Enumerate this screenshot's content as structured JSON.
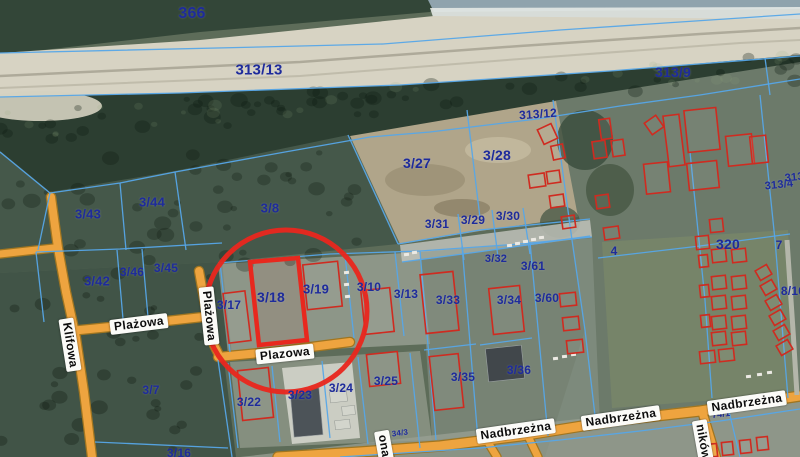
{
  "map": {
    "size": {
      "w": 800,
      "h": 457
    },
    "palette": {
      "base": "#5d6c59",
      "line": "#56a7e8",
      "building_outline": "#cf2b20",
      "highlight": "#e8281e",
      "road_fill": "#eea43f",
      "road_edge": "#a07520",
      "parcel_label": "#1e2b9b",
      "street_label_bg": "#fbfbf8",
      "street_label_text": "#0c0c0c"
    },
    "terrain": [
      {
        "p": "0,0 440,0 430,12 200,32 0,55",
        "f": "#334638"
      },
      {
        "p": "428,0 800,0 800,9 434,12",
        "f": "#8fa3ad"
      },
      {
        "p": "430,8 800,7 800,20 434,20",
        "f": "#e4e9e6",
        "o": 0.9
      },
      {
        "p": "0,53 200,40 434,16 800,19 800,58 610,72 400,86 180,94 0,98",
        "f": "#d7d3c3"
      },
      {
        "p": "0,97 180,93 400,85 610,71 800,55 800,80 700,94 620,105 537,118 430,131 370,136 285,151 175,171 120,182 50,192 0,151",
        "f": "#2c3e31"
      },
      {
        "e": [
          40,
          106,
          62,
          15
        ],
        "f": "#d5d1c1",
        "o": 0.9
      },
      {
        "p": "0,151 50,192 175,171 348,135 398,244 222,262 0,273",
        "f": "#45584a"
      },
      {
        "p": "0,273 222,262 232,355 224,360 236,457 0,457",
        "f": "#415447"
      },
      {
        "p": "553,101 800,62 800,457 545,457 585,330 572,240",
        "f": "#6c7a6a"
      },
      {
        "p": "350,136 556,101 578,217 480,231 400,244",
        "f": "#b0a58a"
      },
      {
        "e": [
          425,
          180,
          40,
          16
        ],
        "f": "#9b9074",
        "o": 0.8
      },
      {
        "e": [
          498,
          150,
          33,
          13
        ],
        "f": "#c3b99d",
        "o": 0.9
      },
      {
        "e": [
          462,
          208,
          28,
          9
        ],
        "f": "#8c8166",
        "o": 0.8
      },
      {
        "e": [
          585,
          140,
          28,
          30
        ],
        "f": "#3a4c3c",
        "o": 0.8
      },
      {
        "e": [
          610,
          190,
          24,
          26
        ],
        "f": "#41523f",
        "o": 0.7
      },
      {
        "e": [
          560,
          222,
          20,
          16
        ],
        "f": "#3f5140",
        "o": 0.7
      },
      {
        "p": "602,242 788,230 795,394 612,408",
        "f": "#778569",
        "o": 0.95
      },
      {
        "p": "218,264 420,252 430,344 228,354",
        "f": "#b5b9af",
        "o": 0.55
      },
      {
        "p": "230,362 420,351 432,440 240,448",
        "f": "#adb1a5",
        "o": 0.5
      },
      {
        "p": "282,368 352,362 360,438 292,444",
        "f": "#d7d8cf",
        "o": 0.85
      },
      {
        "p": "400,245 590,220 592,237 402,262",
        "f": "#c5c7bf",
        "o": 0.8
      },
      {
        "p": "420,252 592,238 600,424 432,440",
        "f": "#8d978a",
        "o": 0.55
      },
      {
        "p": "240,457 800,394 800,457",
        "f": "#99a094",
        "o": 0.75
      }
    ],
    "sand_streaks": [
      {
        "p": "0,76 300,62 520,46 700,34 800,28",
        "c": "rgba(80,75,60,0.30)",
        "w": 2.5
      },
      {
        "p": "0,88 300,76 520,59 740,43 800,40",
        "c": "rgba(125,120,100,0.25)",
        "w": 2
      }
    ],
    "roads": [
      {
        "name": "Klifowa",
        "p": "51,197 58,248 66,292 76,338 84,392 92,457",
        "w": 8
      },
      {
        "name": "west-stub",
        "p": "0,254 54,248",
        "w": 7
      },
      {
        "name": "Plazowa-west",
        "p": "70,331 130,325 203,317",
        "w": 8
      },
      {
        "name": "Plazowa-vertical",
        "p": "199,271 206,310 214,345 220,357",
        "w": 8
      },
      {
        "name": "Plazowa-east",
        "p": "218,357 280,351 350,342",
        "w": 8
      },
      {
        "name": "Nadbrzezna",
        "p": "278,457 360,452 440,446 520,436 620,420 700,411 800,396",
        "w": 9
      },
      {
        "name": "branch-ona",
        "p": "382,444 390,457",
        "w": 7
      },
      {
        "name": "branch-1",
        "p": "486,439 497,457",
        "w": 7
      },
      {
        "name": "branch-2",
        "p": "527,434 538,457",
        "w": 7
      },
      {
        "name": "branch-nikow",
        "p": "702,411 716,457",
        "w": 8
      }
    ],
    "paths": [
      {
        "p": "787,240 793,330 797,395",
        "w": 5,
        "c": "#b4b6aa"
      }
    ],
    "boundaries": [
      "0,53 260,47 383,44 560,30 800,14",
      "0,97 180,93 400,85 610,71 800,56",
      "0,152 50,193",
      "50,193 120,183 175,172 285,152 370,137 430,132 537,119 620,106 700,95 800,79",
      "50,193 38,250",
      "120,183 126,250",
      "175,172 186,250",
      "36,252 120,249 222,243",
      "117,250 123,319",
      "142,249 148,317",
      "36,252 44,322",
      "348,135 398,244",
      "467,110 480,218",
      "553,100 572,240 585,330 596,424",
      "398,244 480,230 590,219",
      "458,214 464,260",
      "492,210 498,257",
      "523,208 530,254",
      "402,262 478,252 590,236",
      "218,263 330,254 420,251 520,244 592,237",
      "220,263 230,352",
      "250,262 259,344",
      "298,257 307,340",
      "345,255 354,338",
      "395,252 404,336",
      "420,251 436,440",
      "462,246 478,440",
      "424,350 476,344",
      "530,242 548,436",
      "480,345 532,338",
      "228,363 238,448",
      "272,366 280,442",
      "322,361 330,438",
      "358,357 368,444",
      "410,353 420,448",
      "95,442 228,448",
      "218,360 232,457",
      "598,258 700,246 790,234",
      "690,152 705,300 712,398",
      "760,95 775,240 788,398",
      "765,58 770,95",
      "728,407 740,457",
      "340,457 480,448 560,440 640,431 720,421 800,409"
    ],
    "buildings": [
      [
        226,
        292,
        22,
        50,
        -7
      ],
      [
        305,
        263,
        35,
        45,
        -6
      ],
      [
        363,
        289,
        29,
        44,
        -6
      ],
      [
        423,
        273,
        33,
        59,
        -6
      ],
      [
        491,
        287,
        31,
        46,
        -6
      ],
      [
        240,
        369,
        31,
        50,
        -6
      ],
      [
        368,
        353,
        31,
        32,
        -6
      ],
      [
        432,
        355,
        29,
        54,
        -6
      ],
      [
        560,
        293,
        16,
        13,
        -6
      ],
      [
        563,
        317,
        16,
        13,
        -6
      ],
      [
        567,
        340,
        16,
        13,
        -6
      ],
      [
        540,
        126,
        15,
        16,
        -25
      ],
      [
        552,
        145,
        12,
        14,
        -12
      ],
      [
        529,
        174,
        16,
        13,
        -8
      ],
      [
        547,
        171,
        13,
        12,
        -8
      ],
      [
        550,
        195,
        14,
        12,
        -8
      ],
      [
        562,
        216,
        13,
        12,
        -8
      ],
      [
        593,
        141,
        13,
        17,
        -8
      ],
      [
        600,
        119,
        11,
        20,
        -8
      ],
      [
        596,
        195,
        13,
        13,
        -8
      ],
      [
        604,
        227,
        15,
        12,
        -8
      ],
      [
        612,
        140,
        12,
        16,
        -8
      ],
      [
        645,
        163,
        24,
        30,
        -6
      ],
      [
        688,
        162,
        30,
        27,
        -6
      ],
      [
        647,
        118,
        14,
        14,
        -35
      ],
      [
        666,
        115,
        16,
        51,
        -7
      ],
      [
        686,
        109,
        32,
        42,
        -6
      ],
      [
        727,
        135,
        26,
        30,
        -6
      ],
      [
        751,
        136,
        16,
        27,
        -6
      ],
      [
        710,
        219,
        13,
        13,
        -6
      ],
      [
        696,
        236,
        13,
        13,
        -6
      ],
      [
        712,
        249,
        14,
        13,
        -6
      ],
      [
        732,
        249,
        14,
        13,
        -6
      ],
      [
        712,
        276,
        14,
        13,
        -6
      ],
      [
        732,
        276,
        14,
        13,
        -6
      ],
      [
        712,
        296,
        14,
        13,
        -6
      ],
      [
        732,
        296,
        14,
        13,
        -6
      ],
      [
        712,
        316,
        14,
        13,
        -6
      ],
      [
        732,
        316,
        14,
        13,
        -6
      ],
      [
        712,
        332,
        14,
        13,
        -6
      ],
      [
        732,
        332,
        14,
        13,
        -6
      ],
      [
        757,
        267,
        13,
        11,
        -30
      ],
      [
        762,
        282,
        13,
        11,
        -30
      ],
      [
        767,
        297,
        13,
        11,
        -30
      ],
      [
        771,
        312,
        13,
        11,
        -30
      ],
      [
        775,
        327,
        13,
        11,
        -30
      ],
      [
        778,
        342,
        13,
        11,
        -30
      ],
      [
        699,
        255,
        9,
        12,
        -6
      ],
      [
        700,
        285,
        9,
        12,
        -6
      ],
      [
        701,
        315,
        9,
        12,
        -6
      ],
      [
        700,
        351,
        15,
        12,
        -6
      ],
      [
        719,
        349,
        15,
        12,
        -6
      ],
      [
        706,
        444,
        11,
        13,
        -6
      ],
      [
        722,
        442,
        11,
        13,
        -6
      ],
      [
        740,
        440,
        11,
        13,
        -6
      ],
      [
        757,
        437,
        11,
        13,
        -6
      ]
    ],
    "dark_buildings": [
      [
        487,
        347,
        36,
        33,
        -6,
        "#41474b"
      ],
      [
        292,
        389,
        29,
        47,
        -5,
        "#4c5358"
      ]
    ],
    "light_buildings": [
      [
        330,
        391,
        17,
        11,
        -6
      ],
      [
        342,
        406,
        13,
        9,
        -6
      ],
      [
        335,
        420,
        15,
        9,
        -6
      ]
    ],
    "cars": [
      [
        507,
        244
      ],
      [
        515,
        242
      ],
      [
        523,
        240
      ],
      [
        531,
        238
      ],
      [
        539,
        236
      ],
      [
        404,
        253
      ],
      [
        412,
        251
      ],
      [
        344,
        271
      ],
      [
        344,
        283
      ],
      [
        345,
        295
      ],
      [
        553,
        357
      ],
      [
        562,
        355
      ],
      [
        571,
        353
      ],
      [
        746,
        375
      ],
      [
        757,
        373
      ],
      [
        767,
        371
      ]
    ],
    "highlight": {
      "circle": {
        "cx": 286,
        "cy": 311,
        "r": 81,
        "stroke_width": 5
      },
      "parcel_polygon": "250,262 298,258 307,340 259,345",
      "parcel_id": "3/18"
    },
    "parcel_labels": [
      {
        "t": "366",
        "x": 192,
        "y": 14,
        "s": 16
      },
      {
        "t": "313/13",
        "x": 259,
        "y": 70,
        "s": 15
      },
      {
        "t": "313/9",
        "x": 673,
        "y": 72,
        "s": 14
      },
      {
        "t": "313/12",
        "x": 538,
        "y": 114,
        "s": 12,
        "r": -4
      },
      {
        "t": "3/27",
        "x": 417,
        "y": 163,
        "s": 14
      },
      {
        "t": "3/28",
        "x": 497,
        "y": 155,
        "s": 14
      },
      {
        "t": "3/31",
        "x": 437,
        "y": 224,
        "s": 12
      },
      {
        "t": "3/29",
        "x": 473,
        "y": 220,
        "s": 12
      },
      {
        "t": "3/30",
        "x": 508,
        "y": 216,
        "s": 12
      },
      {
        "t": "3/8",
        "x": 270,
        "y": 208,
        "s": 13
      },
      {
        "t": "3/43",
        "x": 88,
        "y": 214,
        "s": 13
      },
      {
        "t": "3/44",
        "x": 152,
        "y": 202,
        "s": 13
      },
      {
        "t": "3/42",
        "x": 97,
        "y": 281,
        "s": 13
      },
      {
        "t": "3/46",
        "x": 132,
        "y": 272,
        "s": 12
      },
      {
        "t": "3/45",
        "x": 166,
        "y": 268,
        "s": 12
      },
      {
        "t": "3/17",
        "x": 229,
        "y": 305,
        "s": 12
      },
      {
        "t": "3/18",
        "x": 271,
        "y": 297,
        "s": 14
      },
      {
        "t": "3/19",
        "x": 316,
        "y": 289,
        "s": 13
      },
      {
        "t": "3/10",
        "x": 369,
        "y": 287,
        "s": 12
      },
      {
        "t": "3/13",
        "x": 406,
        "y": 294,
        "s": 12
      },
      {
        "t": "3/33",
        "x": 448,
        "y": 300,
        "s": 12
      },
      {
        "t": "3/32",
        "x": 496,
        "y": 259,
        "s": 11
      },
      {
        "t": "3/61",
        "x": 533,
        "y": 266,
        "s": 12
      },
      {
        "t": "3/34",
        "x": 509,
        "y": 300,
        "s": 12
      },
      {
        "t": "3/60",
        "x": 547,
        "y": 298,
        "s": 12
      },
      {
        "t": "4",
        "x": 614,
        "y": 251,
        "s": 12
      },
      {
        "t": "320",
        "x": 728,
        "y": 244,
        "s": 14
      },
      {
        "t": "7",
        "x": 779,
        "y": 245,
        "s": 12
      },
      {
        "t": "313/4",
        "x": 779,
        "y": 185,
        "s": 11,
        "r": -6
      },
      {
        "t": "313/4",
        "x": 799,
        "y": 177,
        "s": 11,
        "r": -6
      },
      {
        "t": "8/10",
        "x": 793,
        "y": 291,
        "s": 12
      },
      {
        "t": "3/7",
        "x": 151,
        "y": 390,
        "s": 12
      },
      {
        "t": "3/16",
        "x": 179,
        "y": 453,
        "s": 12
      },
      {
        "t": "3/22",
        "x": 249,
        "y": 402,
        "s": 12
      },
      {
        "t": "3/23",
        "x": 300,
        "y": 395,
        "s": 12
      },
      {
        "t": "3/24",
        "x": 341,
        "y": 388,
        "s": 12
      },
      {
        "t": "3/25",
        "x": 386,
        "y": 381,
        "s": 12
      },
      {
        "t": "3/35",
        "x": 463,
        "y": 377,
        "s": 12
      },
      {
        "t": "3/36",
        "x": 519,
        "y": 370,
        "s": 12
      },
      {
        "t": "34/3",
        "x": 400,
        "y": 433,
        "s": 8,
        "r": -7
      },
      {
        "t": "74/1",
        "x": 721,
        "y": 414,
        "s": 9,
        "r": -7
      }
    ],
    "street_labels": [
      {
        "t": "Klifowa",
        "x": 70,
        "y": 345,
        "r": 81
      },
      {
        "t": "Plażowa",
        "x": 139,
        "y": 324,
        "r": -7
      },
      {
        "t": "Plażowa",
        "x": 209,
        "y": 316,
        "r": 84
      },
      {
        "t": "Plazowa",
        "x": 285,
        "y": 354,
        "r": -6
      },
      {
        "t": "Nadbrzeżna",
        "x": 516,
        "y": 431,
        "r": -8
      },
      {
        "t": "Nadbrzeżna",
        "x": 621,
        "y": 418,
        "r": -8
      },
      {
        "t": "Nadbrzeżna",
        "x": 747,
        "y": 403,
        "r": -8
      },
      {
        "t": "ników",
        "x": 703,
        "y": 442,
        "r": 80
      },
      {
        "t": "ona",
        "x": 384,
        "y": 446,
        "r": 80
      }
    ]
  }
}
